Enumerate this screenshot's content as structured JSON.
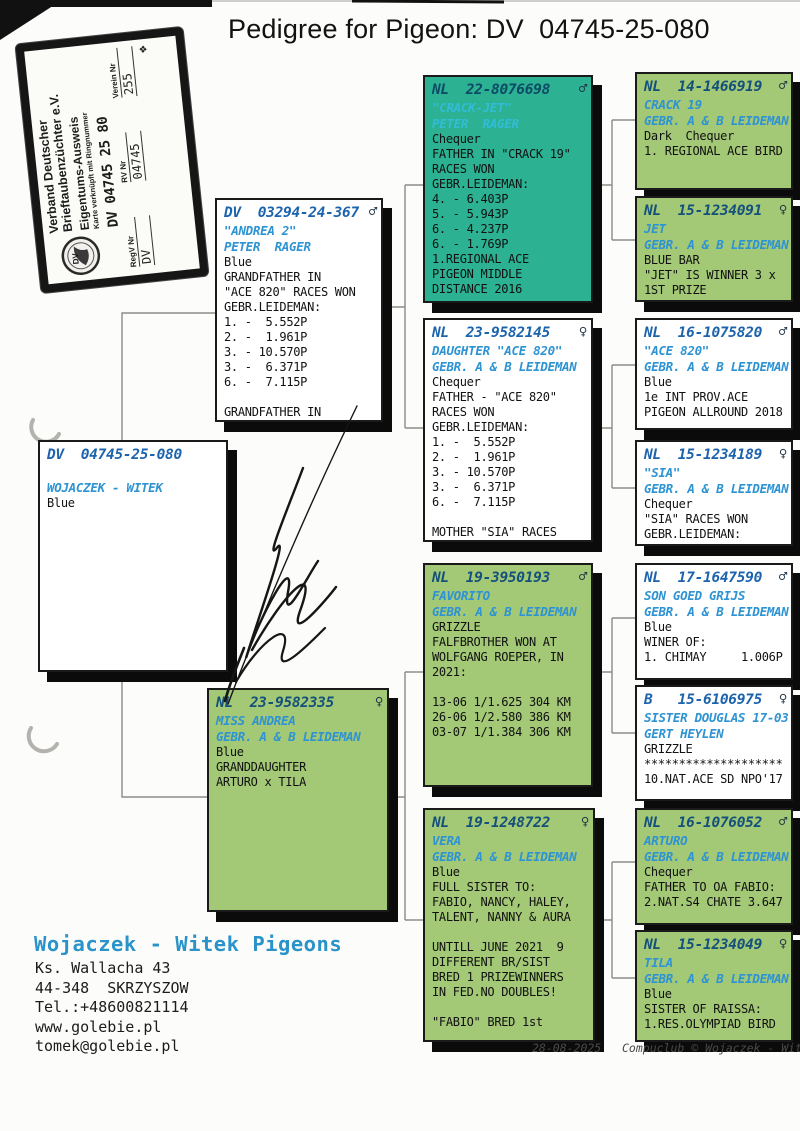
{
  "title": "Pedigree for Pigeon: DV  04745-25-080",
  "stamp": {
    "org_line1": "Verband Deutscher",
    "org_line2": "Brieftaubenzüchter e.V.",
    "doc_type": "Eigentums-Ausweis",
    "subtitle": "Karte verknüpft mit Ringnummer",
    "ring_number": "DV 04745 25 80",
    "logo_text": "DV",
    "fields": [
      {
        "label": "RegV Nr",
        "value": "DV"
      },
      {
        "label": "RV Nr",
        "value": "04745"
      },
      {
        "label": "Verein Nr",
        "value": "255"
      }
    ]
  },
  "boxes": [
    {
      "ring": "DV  04745-25-080",
      "sex": "",
      "name": "WOJACZEK - WITEK",
      "owner": "",
      "body": [
        "Blue"
      ]
    },
    {
      "ring": "DV  03294-24-367",
      "sex": "♂",
      "name": "\"ANDREA 2\"",
      "owner": "PETER  RAGER",
      "body": [
        "Blue",
        "GRANDFATHER IN",
        "\"ACE 820\" RACES WON",
        "GEBR.LEIDEMAN:",
        "1. -  5.552P",
        "2. -  1.961P",
        "3. - 10.570P",
        "3. -  6.371P",
        "6. -  7.115P",
        "",
        "GRANDFATHER IN"
      ]
    },
    {
      "ring": "NL  23-9582335",
      "sex": "♀",
      "name": "MISS ANDREA",
      "owner": "GEBR. A & B LEIDEMAN",
      "body": [
        "Blue",
        "GRANDDAUGHTER",
        "ARTURO x TILA"
      ]
    },
    {
      "ring": "NL  22-8076698",
      "sex": "♂",
      "name": "\"CRACK-JET\"",
      "owner": "PETER  RAGER",
      "body": [
        "Chequer",
        "FATHER IN \"CRACK 19\"",
        "RACES WON",
        "GEBR.LEIDEMAN:",
        "4. - 6.403P",
        "5. - 5.943P",
        "6. - 4.237P",
        "6. - 1.769P",
        "1.REGIONAL ACE",
        "PIGEON MIDDLE",
        "DISTANCE 2016"
      ]
    },
    {
      "ring": "NL  23-9582145",
      "sex": "♀",
      "name": "DAUGHTER \"ACE 820\"",
      "owner": "GEBR. A & B LEIDEMAN",
      "body": [
        "Chequer",
        "FATHER - \"ACE 820\"",
        "RACES WON",
        "GEBR.LEIDEMAN:",
        "1. -  5.552P",
        "2. -  1.961P",
        "3. - 10.570P",
        "3. -  6.371P",
        "6. -  7.115P",
        "",
        "MOTHER \"SIA\" RACES"
      ]
    },
    {
      "ring": "NL  19-3950193",
      "sex": "♂",
      "name": "FAVORITO",
      "owner": "GEBR. A & B LEIDEMAN",
      "body": [
        "GRIZZLE",
        "FALFBROTHER WON AT",
        "WOLFGANG ROEPER, IN",
        "2021:",
        "",
        "13-06 1/1.625 304 KM",
        "26-06 1/2.580 386 KM",
        "03-07 1/1.384 306 KM"
      ]
    },
    {
      "ring": "NL  19-1248722",
      "sex": "♀",
      "name": "VERA",
      "owner": "GEBR. A & B LEIDEMAN",
      "body": [
        "Blue",
        "FULL SISTER TO:",
        "FABIO, NANCY, HALEY,",
        "TALENT, NANNY & AURA",
        "",
        "UNTILL JUNE 2021  9",
        "DIFFERENT BR/SIST",
        "BRED 1 PRIZEWINNERS",
        "IN FED.NO DOUBLES!",
        "",
        "\"FABIO\" BRED 1st"
      ]
    },
    {
      "ring": "NL  14-1466919",
      "sex": "♂",
      "name": "CRACK 19",
      "owner": "GEBR. A & B LEIDEMAN",
      "body": [
        "Dark  Chequer",
        "1. REGIONAL ACE BIRD"
      ]
    },
    {
      "ring": "NL  15-1234091",
      "sex": "♀",
      "name": "JET",
      "owner": "GEBR. A & B LEIDEMAN",
      "body": [
        "BLUE BAR",
        "\"JET\" IS WINNER 3 x",
        "1ST PRIZE"
      ]
    },
    {
      "ring": "NL  16-1075820",
      "sex": "♂",
      "name": "\"ACE 820\"",
      "owner": "GEBR. A & B LEIDEMAN",
      "body": [
        "Blue",
        "1e INT PROV.ACE",
        "PIGEON ALLROUND 2018"
      ]
    },
    {
      "ring": "NL  15-1234189",
      "sex": "♀",
      "name": "\"SIA\"",
      "owner": "GEBR. A & B LEIDEMAN",
      "body": [
        "Chequer",
        "\"SIA\" RACES WON",
        "GEBR.LEIDEMAN:"
      ]
    },
    {
      "ring": "NL  17-1647590",
      "sex": "♂",
      "name": "SON GOED GRIJS",
      "owner": "GEBR. A & B LEIDEMAN",
      "body": [
        "Blue",
        "WINER OF:",
        "1. CHIMAY     1.006P"
      ]
    },
    {
      "ring": "B   15-6106975",
      "sex": "♀",
      "name": "SISTER DOUGLAS 17-03",
      "owner": "GERT HEYLEN",
      "body": [
        "GRIZZLE",
        "********************",
        "10.NAT.ACE SD NPO'17"
      ]
    },
    {
      "ring": "NL  16-1076052",
      "sex": "♂",
      "name": "ARTURO",
      "owner": "GEBR. A & B LEIDEMAN",
      "body": [
        "Chequer",
        "FATHER TO OA FABIO:",
        "2.NAT.S4 CHATE 3.647"
      ]
    },
    {
      "ring": "NL  15-1234049",
      "sex": "♀",
      "name": "TILA",
      "owner": "GEBR. A & B LEIDEMAN",
      "body": [
        "Blue",
        "SISTER OF RAISSA:",
        "1.RES.OLYMPIAD BIRD"
      ]
    }
  ],
  "footer": {
    "loft_name": "Wojaczek - Witek Pigeons",
    "address": [
      "Ks. Wallacha 43",
      "44-348  SKRZYSZOW",
      "Tel.:+48600821114",
      "www.golebie.pl",
      "tomek@golebie.pl"
    ],
    "print_line": "28-08-2025   Compuclub © Wojaczek - Witek Pigeo"
  },
  "colors": {
    "teal_box": "#2cb192",
    "green_box": "#a3c876",
    "ring_blue": "#1c63ad",
    "name_blue": "#2e93d2"
  }
}
